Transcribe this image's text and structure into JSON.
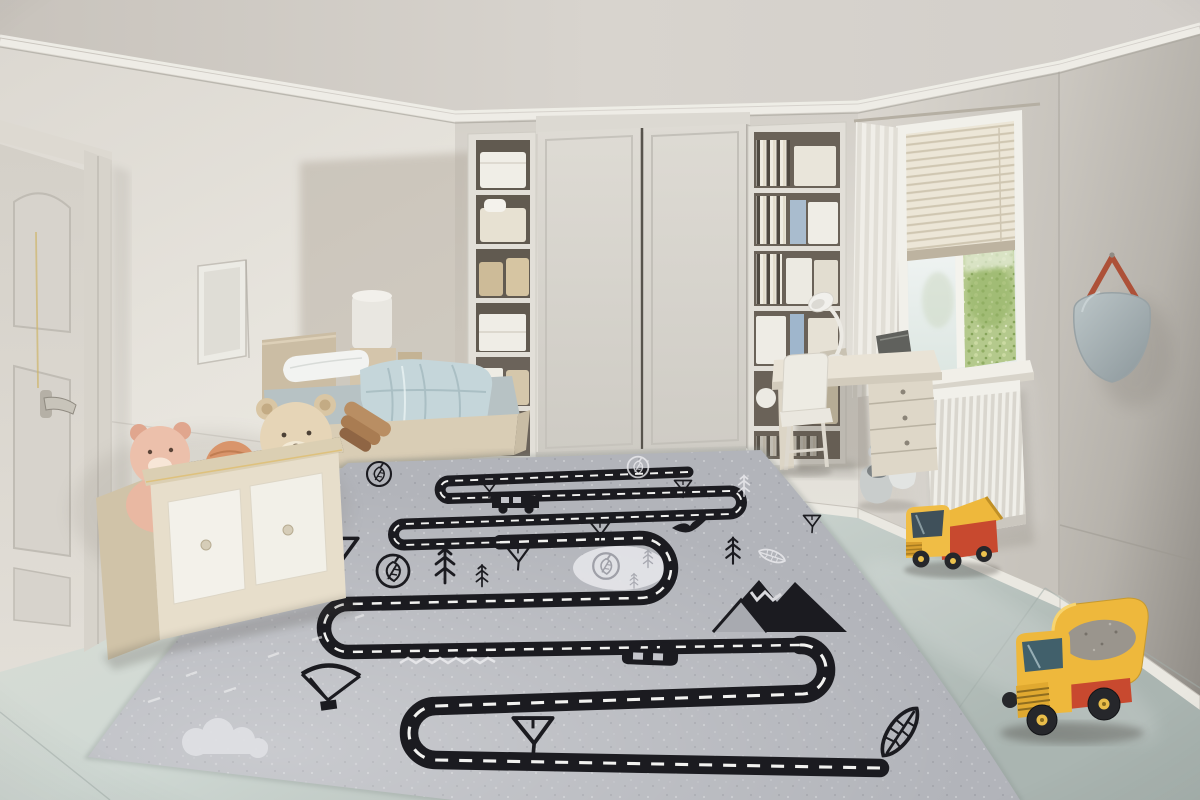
{
  "scene": {
    "setting": "children's bedroom with road-map play rug",
    "objects": [
      "panel-door",
      "wall-picture-frame",
      "toy-chest",
      "plush-bears",
      "crochet-balls",
      "single-bed",
      "pillow",
      "blanket",
      "laundry-hamper",
      "sliding-door-wardrobe",
      "left-shelf-tower",
      "right-shelf-tower",
      "study-desk",
      "desk-lamp",
      "desk-chair",
      "sheer-curtain",
      "venetian-blind-window",
      "garden-view",
      "radiator",
      "strap-mirror",
      "toy-booties",
      "small-toy-truck",
      "toy-dump-truck",
      "road-play-rug"
    ]
  },
  "rug": {
    "road": "winding-two-lane-road-with-dashed-centerline",
    "icons": [
      "triangle-tree",
      "pine-sprig",
      "leaf-badge",
      "side-car",
      "flipped-car",
      "bird",
      "mountain",
      "sail-kite",
      "big-leaf",
      "cloud",
      "clearing-circle",
      "squiggle-doodle",
      "white-sketch-leaf"
    ]
  },
  "palette": {
    "ceiling": "#d3cfc8",
    "wall": "#e4e1da",
    "right_wall_dark": "#938f88",
    "floor": "#ccd5d0",
    "rug": "#b2b4ba",
    "road": "#1b1b20",
    "road_dash": "#f2f2f0",
    "rug_light_spot": "#e3e3e7",
    "wood": "#d8ccb3",
    "mattress": "#b7c2c4",
    "blanket": "#c5d6da",
    "wardrobe_door": "#d8d5ce",
    "greenery": "#b4c98c",
    "truck_yellow": "#eeb83c",
    "truck_red": "#c8492f",
    "mirror_strap": "#ad5138"
  }
}
